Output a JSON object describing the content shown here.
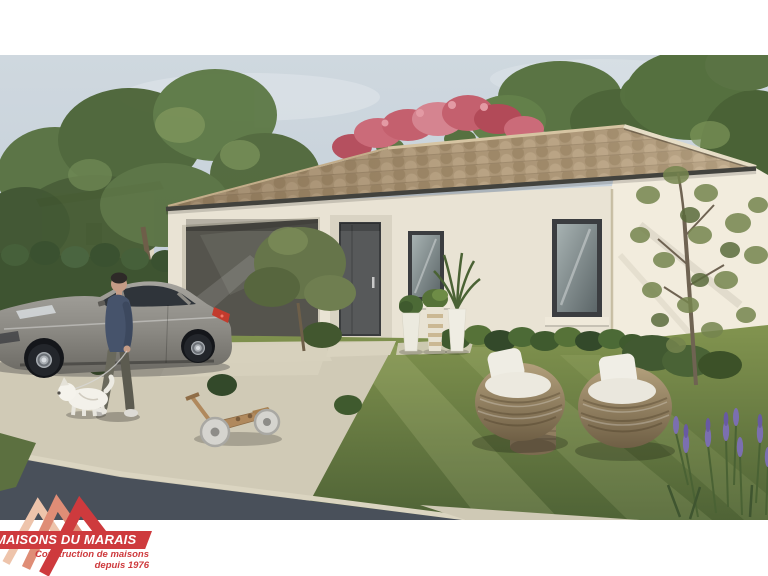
{
  "logo": {
    "brand": "MAISONS DU MARAIS",
    "tagline1": "Construction de maisons",
    "tagline2": "depuis 1976"
  },
  "colors": {
    "logo_red": "#ce3a3d",
    "logo_salmon": "#df8d76",
    "logo_peach": "#eec4ab",
    "sky_top": "#cfd8df",
    "sky_bottom": "#b9c6d2",
    "wall": "#e9e3d4",
    "gable_wall": "#f2ecdd",
    "roof_tile": "#b29c7c",
    "gutter": "#42423d",
    "garage_door": "#55544d",
    "front_door": "#57595a",
    "window_frame": "#3b3d40",
    "window_sill": "#efe9da",
    "grass_light": "#82944f",
    "grass_dark": "#4f6336",
    "driveway": "#d0cab6",
    "road": "#49505a",
    "car_body": "#8d8b85",
    "cushion": "#efede4",
    "wicker": "#9a8767",
    "foliage": "#5e7746",
    "flower_pink": "#c4606e",
    "lavender": "#7b6fb0",
    "toy_wood": "#b0895d"
  },
  "scene": {
    "alt": "3D exterior rendering of a single-storey house with clay tile roof, grey sedan on the driveway, a man walking a small white dog, two wicker armchairs on the lawn and lavender in the foreground",
    "objects": [
      "single-storey house with clay tile roof",
      "grey sectional garage door",
      "grey front door",
      "two windows with white sills",
      "grey sedan parked on the driveway",
      "man walking a small white dog on a leash",
      "wooden balance bike lying on the lawn",
      "two round wicker armchairs with white cushions",
      "wicker side table",
      "three white planters with plants",
      "bougainvillea flowers above the roof ridge",
      "trees, hedge and shrubs",
      "lavender in the foreground",
      "asphalt road and concrete driveway"
    ]
  }
}
